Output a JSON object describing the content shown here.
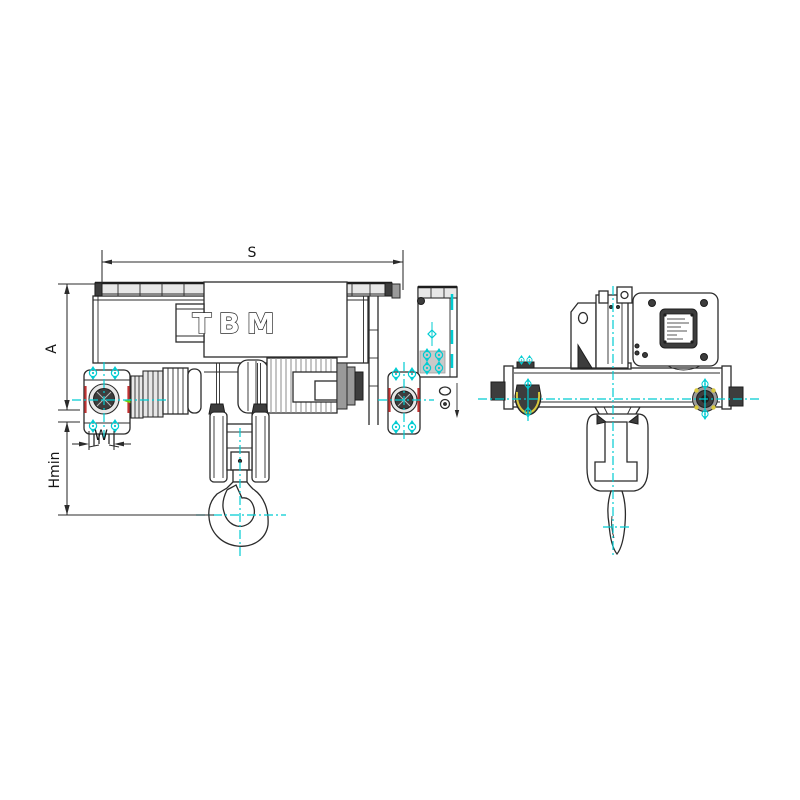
{
  "page": {
    "background": "#ffffff",
    "kind": "technical-drawing",
    "subject": "electric wire rope hoist with low-headroom trolley, side view and end view"
  },
  "drawing": {
    "brand_label": "TBM",
    "dimension_labels": {
      "span": "S",
      "height": "A",
      "wheel_gap": "W",
      "min_headroom": "Hmin"
    },
    "colors": {
      "line": "#2b2b2b",
      "fill_light": "#e7e7e7",
      "centerline_cyan": "#00ccd2",
      "accent_red": "#c23434",
      "accent_green": "#76d400",
      "accent_yellow": "#d8c83c",
      "background": "#ffffff"
    }
  }
}
